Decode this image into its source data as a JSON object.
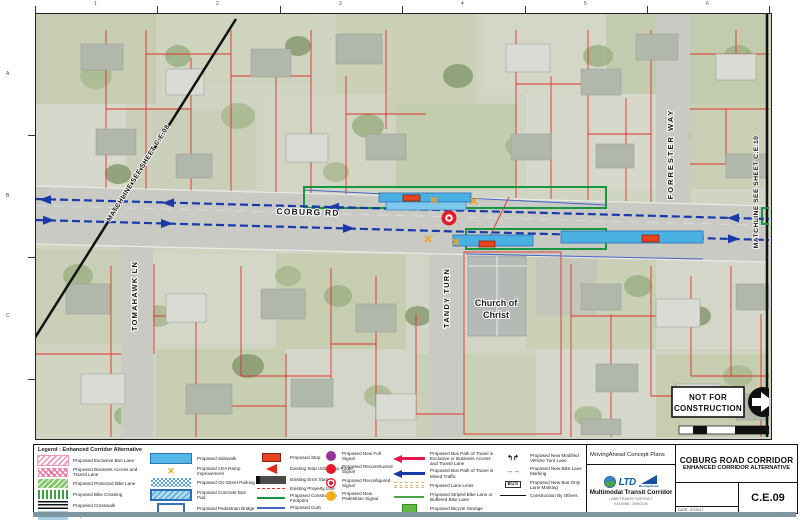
{
  "map": {
    "grid": {
      "cols": [
        "1",
        "2",
        "3",
        "4",
        "5",
        "6"
      ],
      "rows": [
        "A",
        "B",
        "C"
      ]
    },
    "labels": {
      "coburg_rd": "COBURG RD",
      "tandy_turn": "TANDY TURN",
      "tomahawk_ln": "TOMAHAWK LN",
      "forrester_way": "FORRESTER WAY",
      "matchline_left": "MATCHLINE SEE SHEET C.E.08",
      "matchline_right": "MATCHLINE SEE SHEET C.E.10",
      "church_1": "Church of",
      "church_2": "Christ"
    },
    "stamp": {
      "line1": "NOT FOR",
      "line2": "CONSTRUCTION"
    }
  },
  "legend": {
    "title": "Legend : Enhanced Corridor Alternative",
    "col1": [
      "Proposed Exclusive Bus Lane",
      "Proposed Business Access and Transit Lane",
      "Proposed Protected Bike Lane",
      "Proposed Bike Crossing",
      "Proposed Crosswalk",
      "Proposed Median"
    ],
    "col2": [
      "Proposed Sidewalk",
      "Proposed ADA Ramp Improvement",
      "Proposed On-Street Parking",
      "Proposed Concrete Bus Pad",
      "Proposed Pedestrian Bridge"
    ],
    "col3": [
      "Proposed Stop",
      "Existing Stop Utilized by Route",
      "Existing EmX Station",
      "Existing Property Line",
      "Proposed Construction Footprint",
      "Proposed Curb"
    ],
    "col4": [
      "Proposed New Full Signal",
      "Proposed Reconstructed Signal",
      "Proposed Reconfigured Signal",
      "Proposed New Pedestrian Signal"
    ],
    "col5": [
      "Proposed Bus Path of Travel in Exclusive or Business Access and Transit Lane",
      "Proposed Bus Path of Travel in Mixed Traffic",
      "Proposed Lane Lines",
      "Proposed Striped Bike Lane or Buffered Bike Lane",
      "Proposed Bicycle Storage"
    ],
    "col6": [
      "Proposed New Modified Vehicle Turn Lane",
      "Proposed New Bike Lane Marking",
      "Proposed New Bus Only Lane Marking",
      "Construction By Others"
    ]
  },
  "titleblock": {
    "concept_plans": "MovingAhead Concept Plans",
    "ltd": "LTD",
    "movingahead": "MovingAhead",
    "multimodal": "Multimodal Transit Corridor",
    "org_line1": "LANE TRANSIT DISTRICT",
    "org_line2": "EUGENE, OREGON",
    "title1": "COBURG ROAD CORRIDOR",
    "title2": "ENHANCED CORRIDOR ALTERNATIVE",
    "date": "DATE:  07/2017",
    "sheet": "C.E.09"
  },
  "icons": {
    "ada_ramp": "✕",
    "turn_lane": "↰↱",
    "bike_marking": "→→",
    "bus_marking": "BUS"
  },
  "colors": {
    "bus_path_mixed": "#1839a8",
    "bus_path_exclusive": "#e8174a",
    "construction_footprint": "#17953f",
    "property_line": "#e03128",
    "proposed_stop": "#e8431c",
    "sidewalk": "#4ab0e4",
    "signal_full": "#993399",
    "signal_reconstructed": "#e8192c",
    "signal_pedestrian": "#f5b117"
  }
}
